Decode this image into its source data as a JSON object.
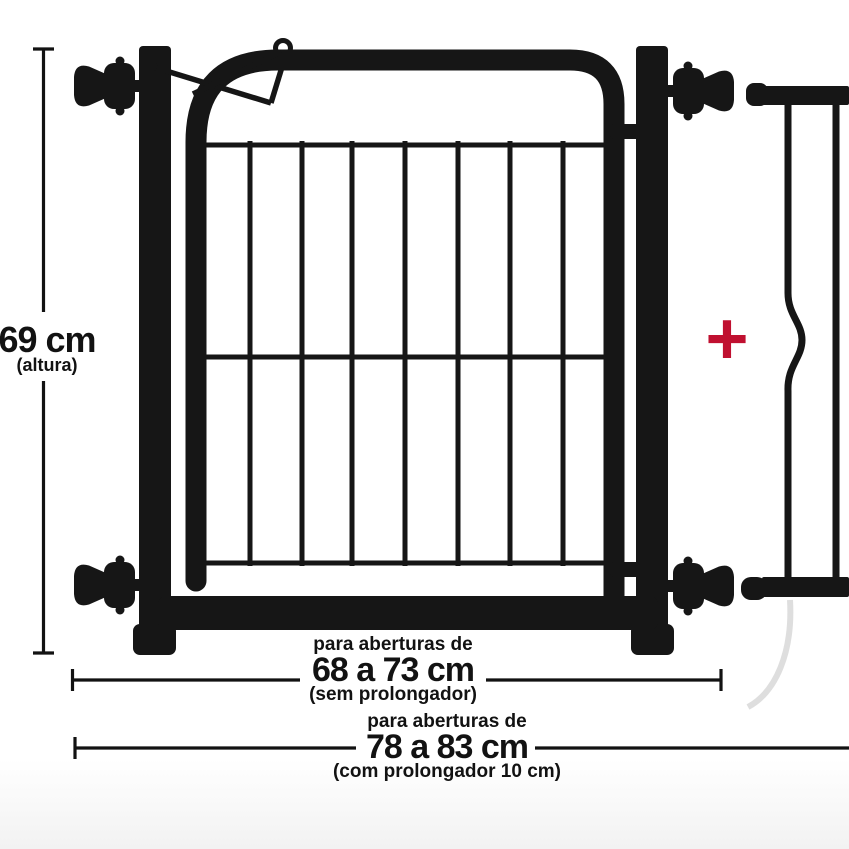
{
  "colors": {
    "gate": "#161616",
    "dimension": "#121212",
    "plus_red": "#c01030",
    "background": "#ffffff",
    "shadow": "#cccccc"
  },
  "dimensions": {
    "height": {
      "value": "69 cm",
      "qualifier": "(altura)"
    },
    "opening_without_extension": {
      "intro": "para aberturas de",
      "value": "68 a 73 cm",
      "qualifier": "(sem prolongador)"
    },
    "opening_with_extension": {
      "intro": "para aberturas de",
      "value": "78 a 83 cm",
      "qualifier": "(com prolongador 10 cm)"
    }
  },
  "symbols": {
    "plus": "+"
  }
}
